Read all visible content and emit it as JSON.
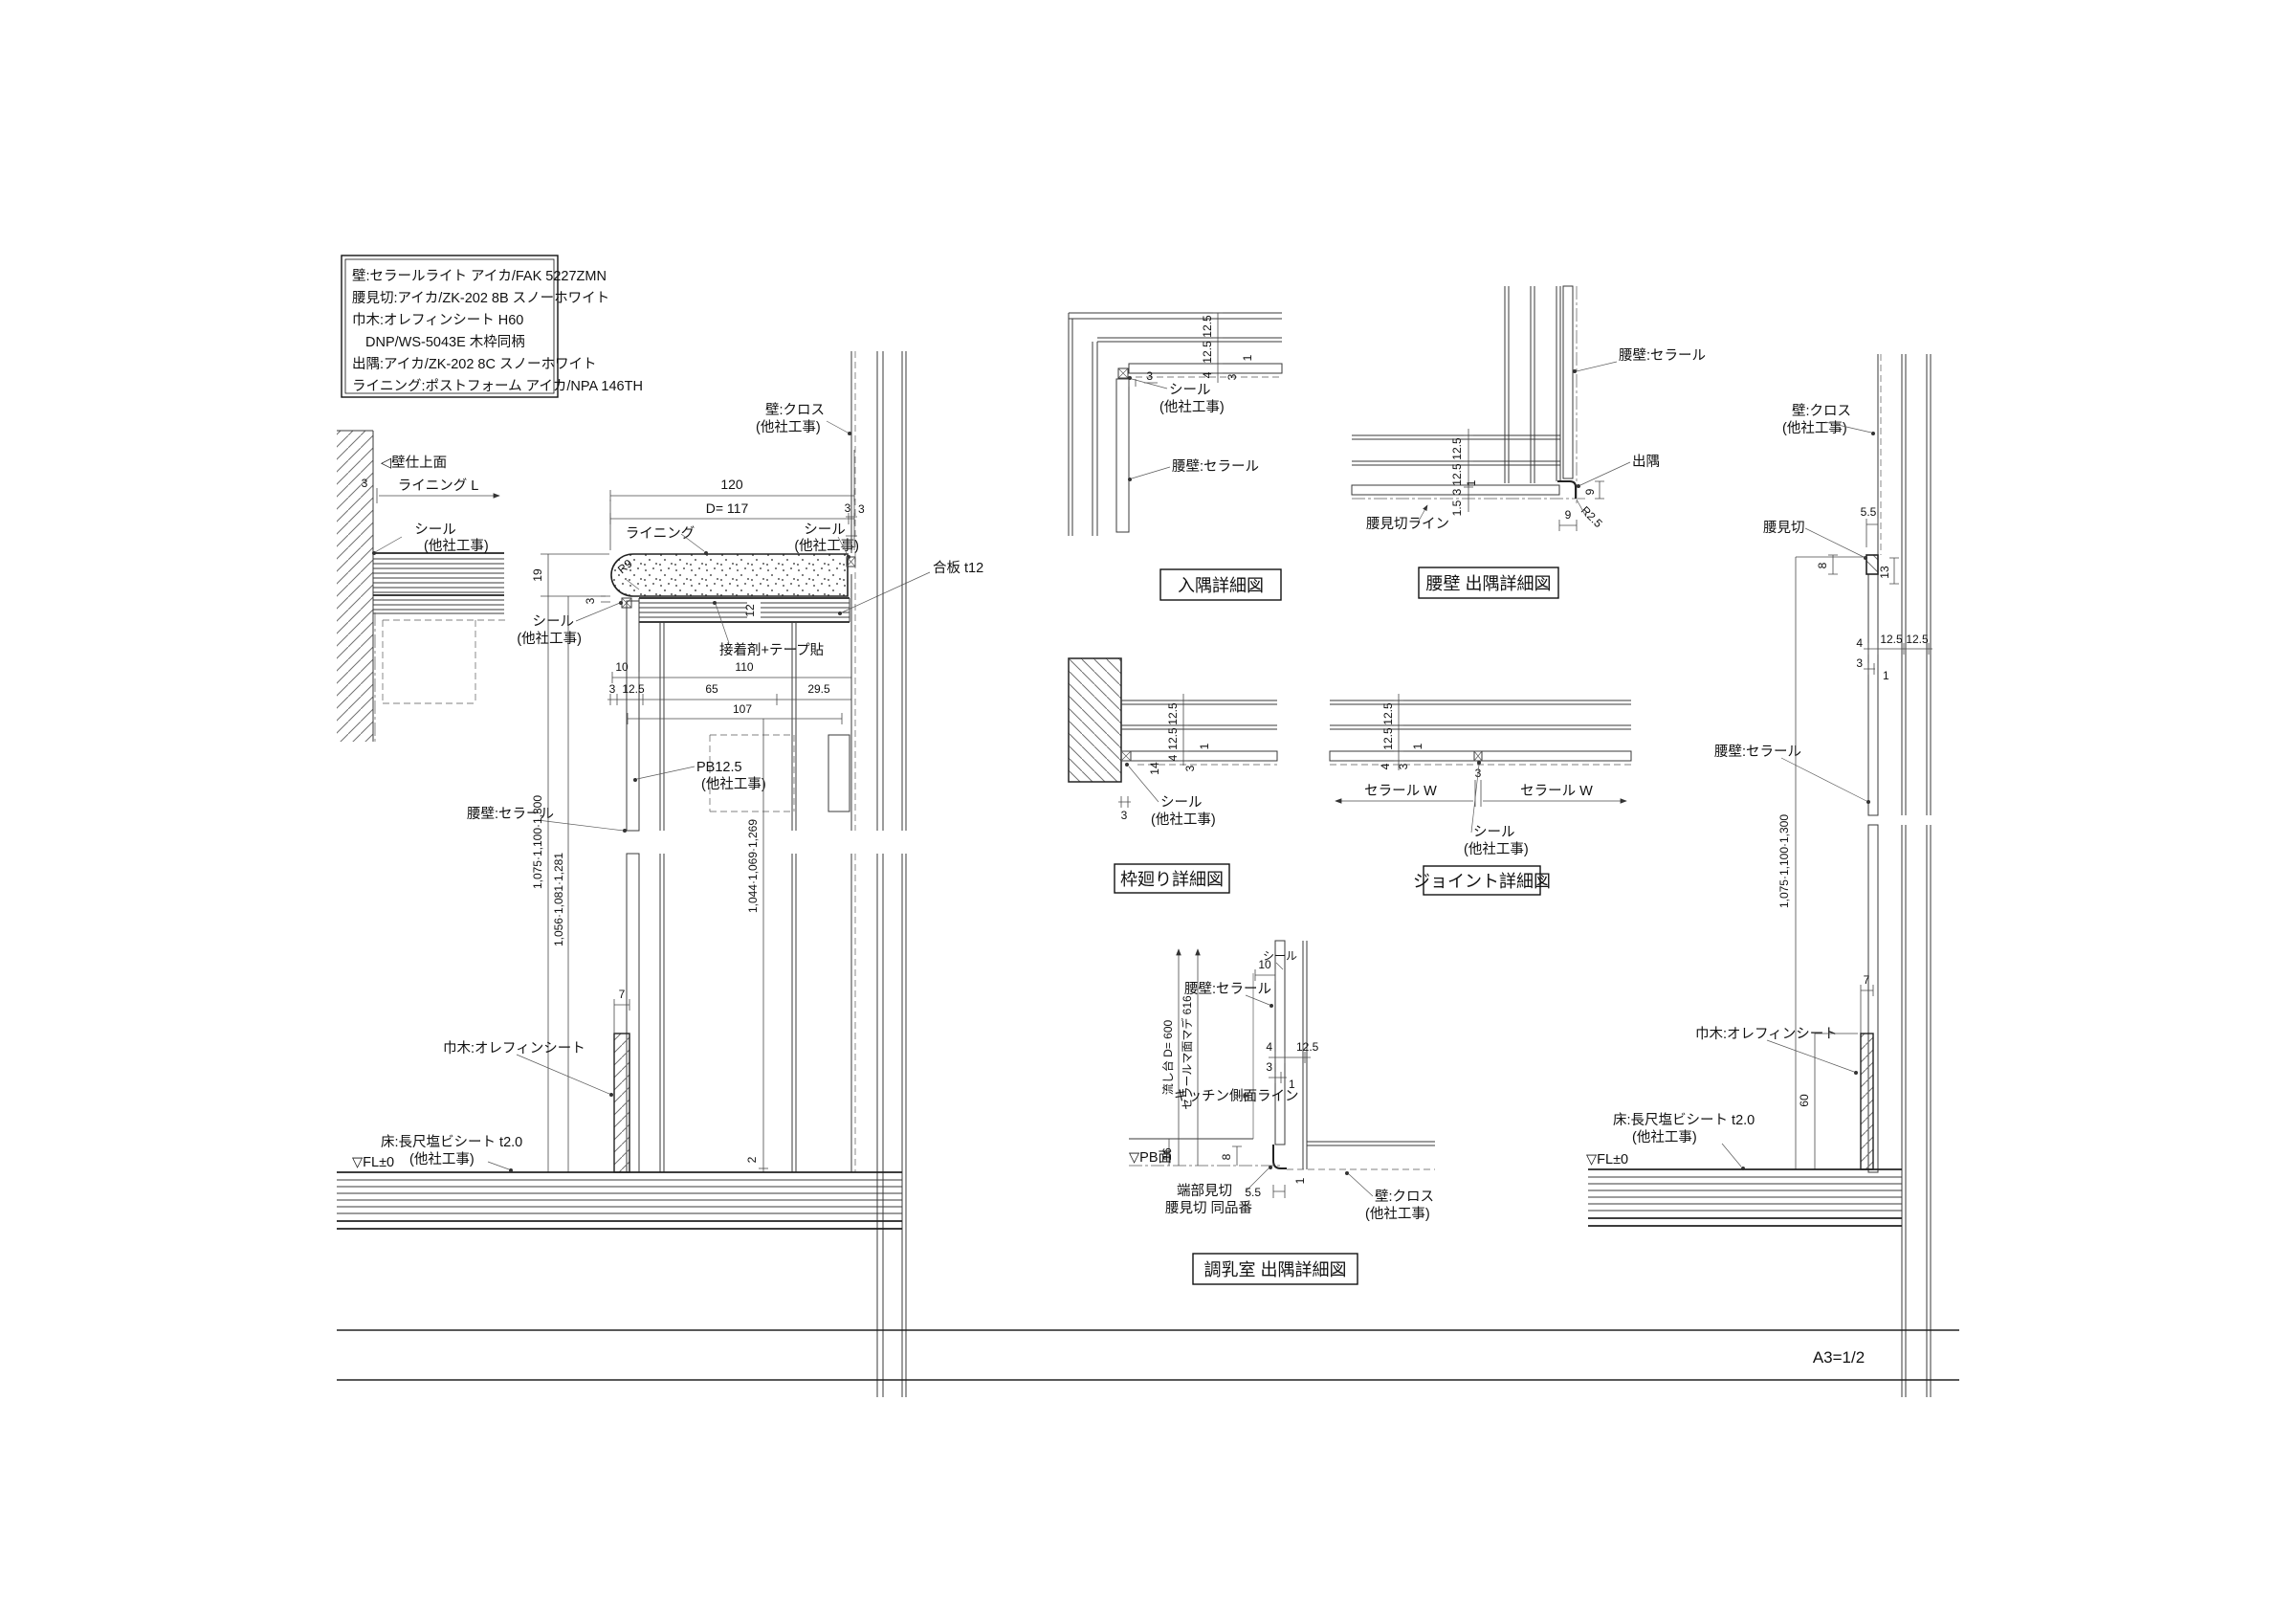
{
  "sheet": {
    "scale_note": "A3=1/2"
  },
  "legend": {
    "lines": [
      "壁:セラールライト アイカ/FAK 5227ZMN",
      "腰見切:アイカ/ZK-202 8B スノーホワイト",
      "巾木:オレフィンシート H60",
      "DNP/WS-5043E 木枠同柄",
      "出隅:アイカ/ZK-202 8C スノーホワイト",
      "ライニング:ポストフォーム アイカ/NPA 146TH"
    ]
  },
  "main": {
    "wall_face": "◁壁仕上面",
    "dim3a": "3",
    "lining_l": "ライニング L",
    "seal_l1": "シール",
    "other1": "(他社工事)",
    "dim19": "19",
    "dim3b": "3",
    "seal_l2": "シール",
    "other2": "(他社工事)",
    "r9": "R9",
    "dim120": "120",
    "dimd117": "D= 117",
    "dim3c": "3",
    "lining": "ライニング",
    "seal_r": "シール",
    "other3": "(他社工事)",
    "wall_cloth1": "壁:クロス",
    "wall_cloth2": "(他社工事)",
    "dim3d": "3",
    "plywood": "合板 t12",
    "dim12": "12",
    "adhesive": "接着剤+テープ貼",
    "dim10": "10",
    "dim110": "110",
    "dim3e": "3",
    "dim12_5": "12.5",
    "dim65": "65",
    "dim29_5": "29.5",
    "dim107": "107",
    "pb1": "PB12.5",
    "pb2": "(他社工事)",
    "kneewall": "腰壁:セラール",
    "vdim1": "1,075·1,100·1,300",
    "vdim2": "1,056·1,081·1,281",
    "vdim3": "1,044·1,069·1,269",
    "dim7": "7",
    "dim2": "2",
    "skirting": "巾木:オレフィンシート",
    "floor1": "床:長尺塩ビシート t2.0",
    "floor2": "(他社工事)",
    "fl": "▽FL±0"
  },
  "irisumi": {
    "title": "入隅詳細図",
    "dim12_5a": "12.5",
    "dim12_5b": "12.5",
    "dim4": "4",
    "dim3a": "3",
    "dim1": "1",
    "dim3b": "3",
    "seal1": "シール",
    "seal2": "(他社工事)",
    "kneewall": "腰壁:セラール"
  },
  "desumi": {
    "title": "腰壁 出隅詳細図",
    "kneewall": "腰壁:セラール",
    "corner": "出隅",
    "r2_5": "R2.5",
    "mikiri_line": "腰見切ライン",
    "dim12_5a": "12.5",
    "dim12_5b": "12.5",
    "dim1": "1",
    "dim3": "3",
    "dim1_5": "1.5",
    "dim9a": "9",
    "dim9b": "9"
  },
  "waku": {
    "title": "枠廻り詳細図",
    "dim12_5a": "12.5",
    "dim12_5b": "12.5",
    "dim4": "4",
    "dim14": "14",
    "dim10": "10",
    "dim3a": "3",
    "dim1": "1",
    "dim3b": "3",
    "seal1": "シール",
    "seal2": "(他社工事)"
  },
  "joint": {
    "title": "ジョイント詳細図",
    "dim12_5a": "12.5",
    "dim12_5b": "12.5",
    "dim4": "4",
    "dim3a": "3",
    "dim1": "1",
    "dim3b": "3",
    "ceral_w_l": "セラール W",
    "ceral_w_r": "セラール W",
    "seal1": "シール",
    "seal2": "(他社工事)"
  },
  "chonyu": {
    "title": "調乳室 出隅詳細図",
    "seal": "シール",
    "dim10": "10",
    "kneewall": "腰壁:セラール",
    "sink": "流し台 D= 600",
    "ceral_face": "セラールマ面マデ 616",
    "kitchen_line": "キッチン側面ライン",
    "dim4": "4",
    "dim12_5": "12.5",
    "dim3": "3",
    "dim1a": "1",
    "dim16": "16",
    "dim8": "8",
    "pb_face": "▽PB面",
    "edge1": "端部見切",
    "edge2": "腰見切 同品番",
    "dim5_5": "5.5",
    "dim1b": "1",
    "wall1": "壁:クロス",
    "wall2": "(他社工事)"
  },
  "right": {
    "wall1": "壁:クロス",
    "wall2": "(他社工事)",
    "mikiri": "腰見切",
    "dim5_5": "5.5",
    "dim8": "8",
    "dim13": "13",
    "dim4": "4",
    "dim12_5a": "12.5",
    "dim12_5b": "12.5",
    "dim3": "3",
    "dim1": "1",
    "kneewall": "腰壁:セラール",
    "vdim": "1,075·1,100·1,300",
    "dim7": "7",
    "skirting": "巾木:オレフィンシート",
    "dim60": "60",
    "floor1": "床:長尺塩ビシート t2.0",
    "floor2": "(他社工事)",
    "fl": "▽FL±0"
  }
}
